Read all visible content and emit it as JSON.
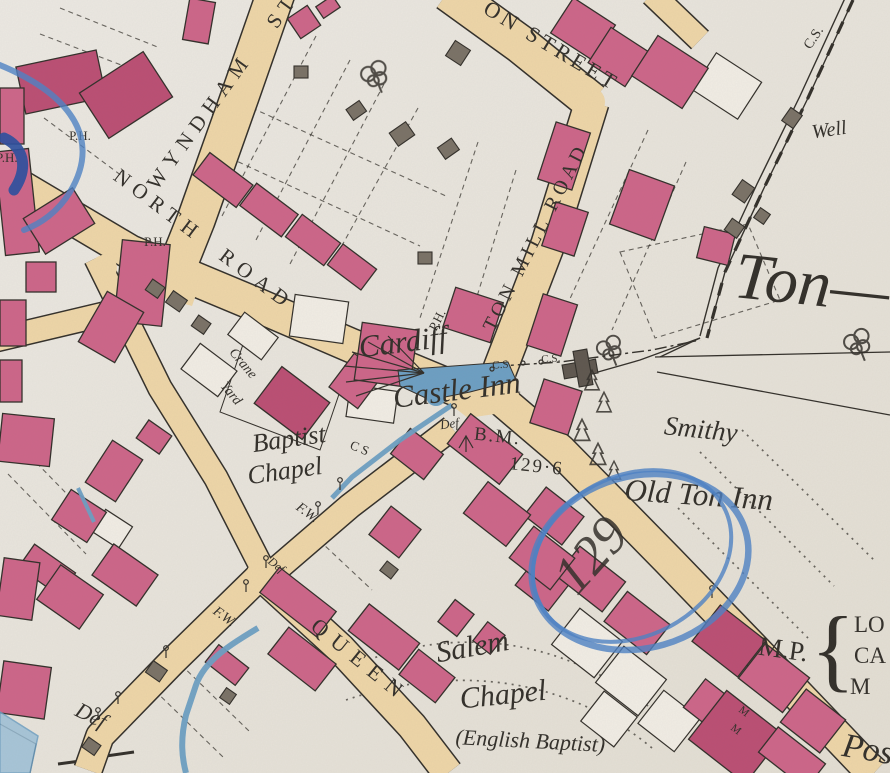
{
  "palette": {
    "paper": "#e9e5dd",
    "ink": "#33302b",
    "building_pink": "#cd6689",
    "building_pink_dark": "#bb4f74",
    "building_gray": "#7a7267",
    "road_tan": "#eed6a8",
    "water_blue": "#6d9fc3",
    "crayon_blue": "#4d82c6",
    "crayon_navy": "#2c4f9e"
  },
  "streets": {
    "wyndham": "WYNDHAM",
    "wyndham_abbrev": "ST",
    "on_street": "ON STREET",
    "ton_mill_road": "TON MILL ROAD",
    "north_road": "NORTH ROAD",
    "queen": "QUEEN"
  },
  "places": {
    "cardiff": "Cardiff",
    "castle_inn": "Castle Inn",
    "baptist": "Baptist",
    "baptist_chapel": "Chapel",
    "crane": "Crane",
    "yard": "Yard",
    "smithy": "Smithy",
    "old_ton_inn": "Old Ton Inn",
    "ton": "Ton—",
    "well": "Well",
    "salem": "Salem",
    "salem_chapel": "Chapel",
    "salem_denomination": "(English Baptist)",
    "post": "Pos",
    "milepost": "M.P.",
    "milepost_brace": "{",
    "milepost_line1": "LO",
    "milepost_line2": "CA",
    "milepost_line3": "M"
  },
  "markers": {
    "public_house": "P.H.",
    "bench_mark": "B.M.",
    "bench_mark_value": "129·6",
    "boundary_cs": "C.S.",
    "boundary_cs_short": "C S",
    "fence_fw": "F.W.",
    "boundary_def": "Def",
    "building_initial": "M"
  },
  "annotations": {
    "crayon_number": "129"
  }
}
